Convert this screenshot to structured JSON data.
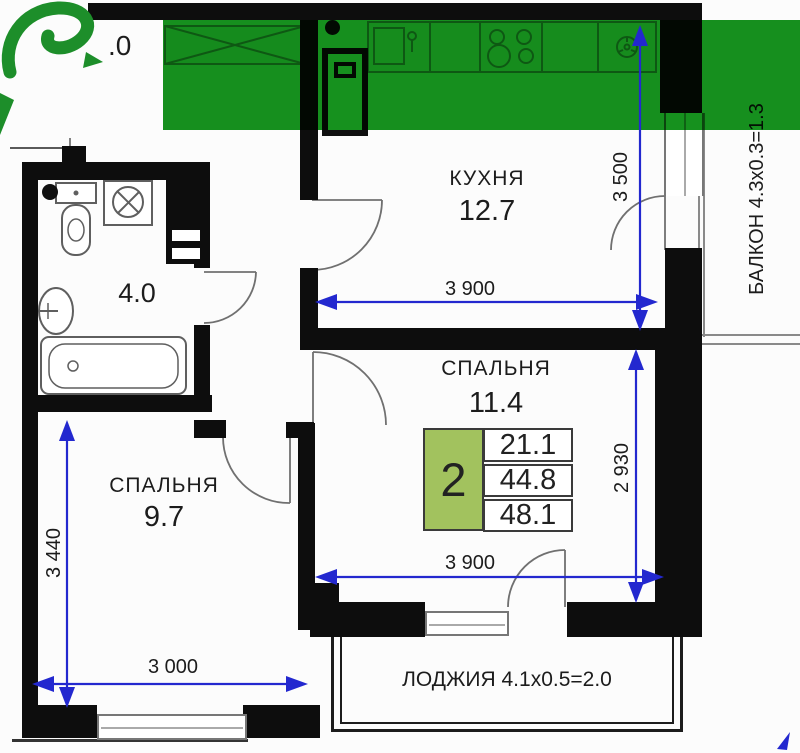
{
  "stats": {
    "rooms_count": "2",
    "living_area": "21.1",
    "apartment_area": "44.8",
    "total_area": "48.1"
  },
  "rooms": {
    "kitchen": {
      "name": "КУХНЯ",
      "area": "12.7"
    },
    "bedroom_main": {
      "name": "СПАЛЬНЯ",
      "area": "11.4"
    },
    "bedroom_second": {
      "name": "СПАЛЬНЯ",
      "area": "9.7"
    },
    "bathroom": {
      "area": "4.0"
    },
    "hallway": {
      "area_visible": ".0"
    },
    "balcony": {
      "label": "БАЛКОН 4.3x0.3=1.3"
    },
    "loggia": {
      "label": "ЛОДЖИЯ 4.1x0.5=2.0"
    }
  },
  "dimensions": {
    "kitchen_height": "3 500",
    "kitchen_width": "3 900",
    "bedroom_main_height": "2 930",
    "bedroom_main_width": "3 900",
    "bedroom_second_height": "3 440",
    "bedroom_second_width": "3 000"
  },
  "colors": {
    "overlay_green": "#16911e",
    "logo_green": "#1d8e2a",
    "stats_green": "#a2c25e",
    "dimension_blue": "#2328cf",
    "wall_black": "#0d0d0d"
  }
}
